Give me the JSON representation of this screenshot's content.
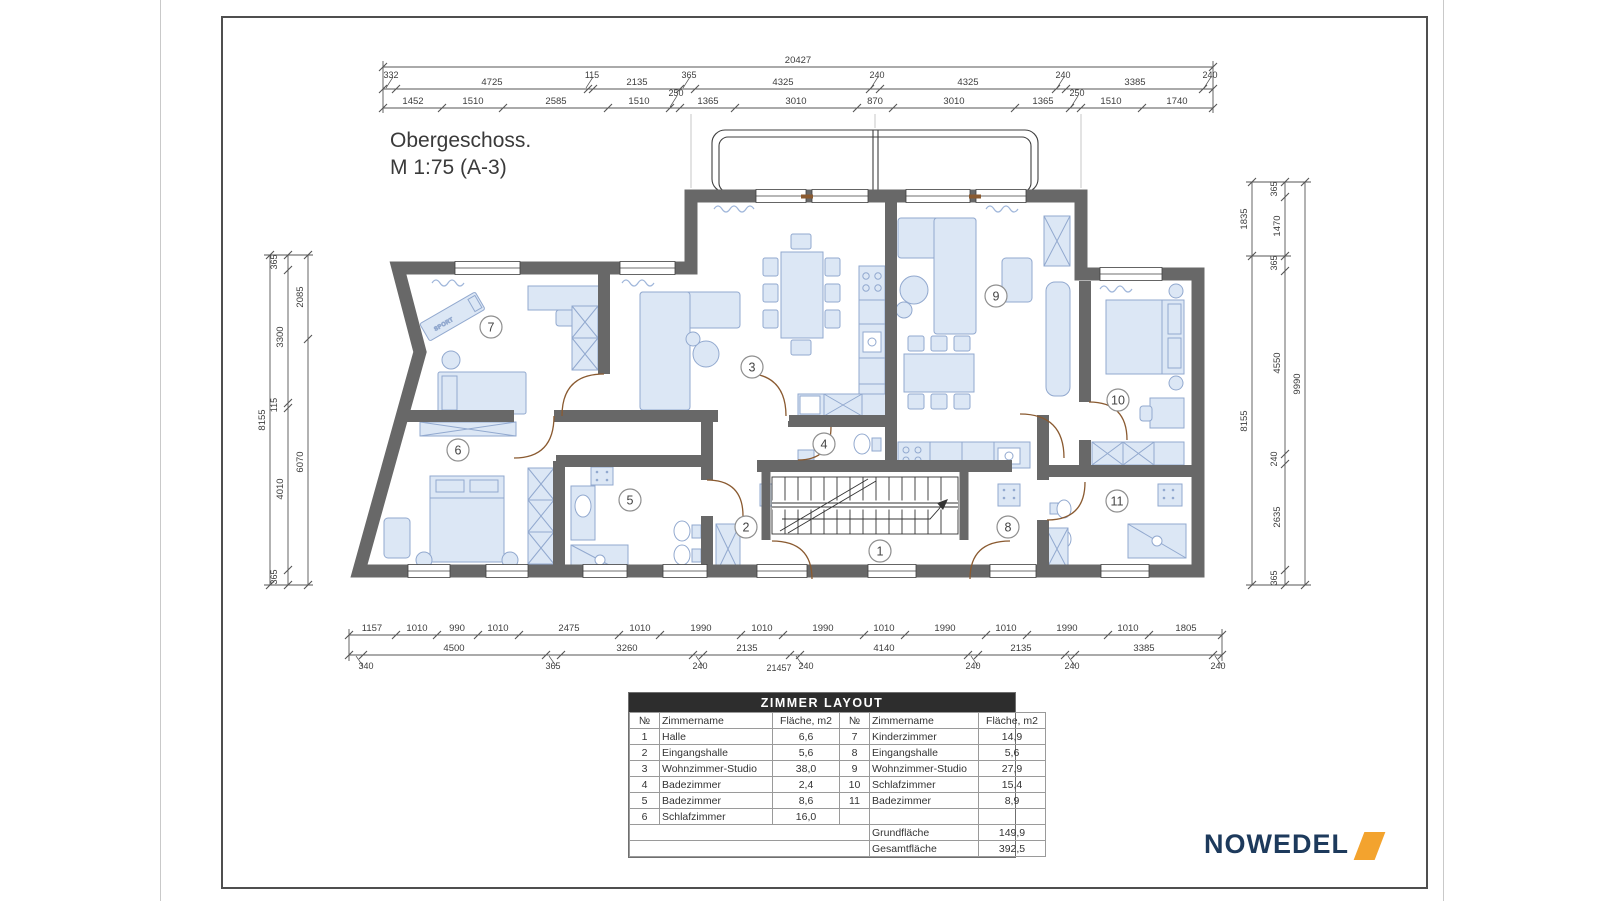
{
  "page": {
    "title_line1": "Obergeschoss.",
    "title_line2": "M 1:75 (A-3)"
  },
  "logo": {
    "text": "NOWEDEL"
  },
  "colors": {
    "wall": "#686868",
    "furniture_fill": "#dce7f5",
    "furniture_stroke": "#92a9cf",
    "door": "#8a5a30",
    "logo_navy": "#1d3a5c",
    "logo_orange": "#f3a32e",
    "table_header_bg": "#2d2d2d"
  },
  "plan": {
    "treadmill_label": "SPORT"
  },
  "rooms": [
    "1",
    "2",
    "3",
    "4",
    "5",
    "6",
    "7",
    "8",
    "9",
    "10",
    "11"
  ],
  "dims": {
    "top_total": "20427",
    "top_mid": [
      "332",
      "4725",
      "115",
      "2135",
      "365",
      "4325",
      "240",
      "4325",
      "240",
      "3385",
      "240"
    ],
    "top_inner": [
      "1452",
      "1510",
      "2585",
      "1510",
      "250",
      "1365",
      "3010",
      "870",
      "3010",
      "1365",
      "250",
      "1510",
      "1740"
    ],
    "bottom_inner": [
      "1157",
      "1010",
      "990",
      "1010",
      "2475",
      "1010",
      "1990",
      "1010",
      "1990",
      "1010",
      "1990",
      "1010",
      "1990",
      "1010",
      "1805"
    ],
    "bottom_mid": [
      "4500",
      "3260",
      "2135",
      "4140",
      "2135",
      "3385"
    ],
    "bottom_small": [
      "340",
      "365",
      "240",
      "240",
      "240",
      "240",
      "240"
    ],
    "bottom_total": "21457",
    "left_outer": "8155",
    "left_mid": [
      "365",
      "3300",
      "115",
      "4010",
      "365"
    ],
    "left_inner": [
      "2085",
      "6070"
    ],
    "right_inner": [
      "1835",
      "8155"
    ],
    "right_mid": [
      "365",
      "1470",
      "365",
      "4550",
      "240",
      "2635",
      "365"
    ],
    "right_outer": "9990"
  },
  "table": {
    "title": "ZIMMER LAYOUT",
    "headers": [
      "№",
      "Zimmername",
      "Fläche, m2",
      "№",
      "Zimmername",
      "Fläche, m2"
    ],
    "rows": [
      [
        "1",
        "Halle",
        "6,6",
        "7",
        "Kinderzimmer",
        "14,9"
      ],
      [
        "2",
        "Eingangshalle",
        "5,6",
        "8",
        "Eingangshalle",
        "5,6"
      ],
      [
        "3",
        "Wohnzimmer-Studio",
        "38,0",
        "9",
        "Wohnzimmer-Studio",
        "27,9"
      ],
      [
        "4",
        "Badezimmer",
        "2,4",
        "10",
        "Schlafzimmer",
        "15,4"
      ],
      [
        "5",
        "Badezimmer",
        "8,6",
        "11",
        "Badezimmer",
        "8,9"
      ],
      [
        "6",
        "Schlafzimmer",
        "16,0",
        "",
        "",
        ""
      ]
    ],
    "footer": [
      {
        "label": "Grundfläche",
        "value": "149,9"
      },
      {
        "label": "Gesamtfläche",
        "value": "392,5"
      }
    ]
  }
}
